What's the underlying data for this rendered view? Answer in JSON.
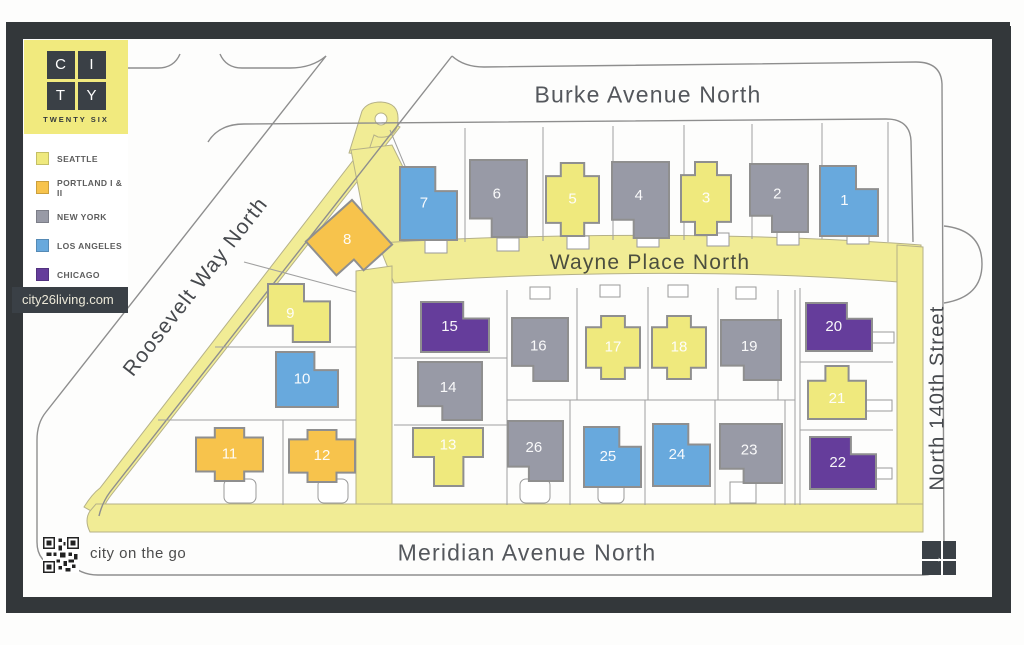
{
  "brand": {
    "logo_letters": [
      "C",
      "I",
      "T",
      "Y"
    ],
    "logo_subtitle": "TWENTY SIX",
    "website": "city26living.com",
    "tagline": "city on the go"
  },
  "legend": {
    "items": [
      {
        "key": "seattle",
        "label": "SEATTLE",
        "color": "#efe97d"
      },
      {
        "key": "portland",
        "label": "PORTLAND I & II",
        "color": "#f7c34c"
      },
      {
        "key": "newyork",
        "label": "NEW YORK",
        "color": "#989aa6"
      },
      {
        "key": "losangeles",
        "label": "LOS ANGELES",
        "color": "#68a9dd"
      },
      {
        "key": "chicago",
        "label": "CHICAGO",
        "color": "#653d9b"
      }
    ]
  },
  "map": {
    "streets": {
      "burke": "Burke Avenue North",
      "wayne": "Wayne Place North",
      "meridian": "Meridian Avenue North",
      "roosevelt": "Roosevelt Way North",
      "n140": "North 140th Street"
    },
    "colors": {
      "seattle": "#efe97d",
      "portland": "#f7c34c",
      "newyork": "#989aa6",
      "losangeles": "#68a9dd",
      "chicago": "#653d9b",
      "road": "#f1ec95"
    },
    "houses": [
      {
        "num": 1,
        "theme": "losangeles",
        "x": 820,
        "y": 166,
        "w": 58,
        "h": 70,
        "shape": "a"
      },
      {
        "num": 2,
        "theme": "newyork",
        "x": 750,
        "y": 164,
        "w": 58,
        "h": 68,
        "shape": "b"
      },
      {
        "num": 3,
        "theme": "seattle",
        "x": 681,
        "y": 162,
        "w": 50,
        "h": 73,
        "shape": "c"
      },
      {
        "num": 4,
        "theme": "newyork",
        "x": 612,
        "y": 162,
        "w": 57,
        "h": 76,
        "shape": "b"
      },
      {
        "num": 5,
        "theme": "seattle",
        "x": 546,
        "y": 163,
        "w": 53,
        "h": 73,
        "shape": "c"
      },
      {
        "num": 6,
        "theme": "newyork",
        "x": 470,
        "y": 160,
        "w": 57,
        "h": 77,
        "shape": "b"
      },
      {
        "num": 7,
        "theme": "losangeles",
        "x": 400,
        "y": 167,
        "w": 57,
        "h": 73,
        "shape": "a"
      },
      {
        "num": 8,
        "theme": "portland",
        "x": 318,
        "y": 213,
        "w": 62,
        "h": 60,
        "shape": "b",
        "rot": -42
      },
      {
        "num": 9,
        "theme": "seattle",
        "x": 268,
        "y": 284,
        "w": 62,
        "h": 58,
        "shape": "g"
      },
      {
        "num": 10,
        "theme": "losangeles",
        "x": 276,
        "y": 352,
        "w": 62,
        "h": 55,
        "shape": "a"
      },
      {
        "num": 11,
        "theme": "portland",
        "x": 196,
        "y": 428,
        "w": 67,
        "h": 53,
        "shape": "c"
      },
      {
        "num": 12,
        "theme": "portland",
        "x": 289,
        "y": 430,
        "w": 66,
        "h": 52,
        "shape": "c"
      },
      {
        "num": 13,
        "theme": "seattle",
        "x": 413,
        "y": 428,
        "w": 70,
        "h": 58,
        "shape": "e"
      },
      {
        "num": 14,
        "theme": "newyork",
        "x": 418,
        "y": 362,
        "w": 64,
        "h": 58,
        "shape": "b"
      },
      {
        "num": 15,
        "theme": "chicago",
        "x": 421,
        "y": 302,
        "w": 68,
        "h": 50,
        "shape": "a"
      },
      {
        "num": 16,
        "theme": "newyork",
        "x": 512,
        "y": 318,
        "w": 56,
        "h": 63,
        "shape": "b"
      },
      {
        "num": 17,
        "theme": "seattle",
        "x": 586,
        "y": 316,
        "w": 54,
        "h": 63,
        "shape": "c"
      },
      {
        "num": 18,
        "theme": "seattle",
        "x": 652,
        "y": 316,
        "w": 54,
        "h": 63,
        "shape": "c"
      },
      {
        "num": 19,
        "theme": "newyork",
        "x": 721,
        "y": 320,
        "w": 60,
        "h": 60,
        "shape": "b"
      },
      {
        "num": 20,
        "theme": "chicago",
        "x": 806,
        "y": 303,
        "w": 66,
        "h": 48,
        "shape": "a"
      },
      {
        "num": 21,
        "theme": "seattle",
        "x": 808,
        "y": 366,
        "w": 58,
        "h": 53,
        "shape": "f"
      },
      {
        "num": 22,
        "theme": "chicago",
        "x": 810,
        "y": 437,
        "w": 66,
        "h": 52,
        "shape": "a"
      },
      {
        "num": 23,
        "theme": "newyork",
        "x": 720,
        "y": 424,
        "w": 62,
        "h": 59,
        "shape": "b"
      },
      {
        "num": 24,
        "theme": "losangeles",
        "x": 653,
        "y": 424,
        "w": 57,
        "h": 62,
        "shape": "a"
      },
      {
        "num": 25,
        "theme": "losangeles",
        "x": 584,
        "y": 427,
        "w": 57,
        "h": 60,
        "shape": "a"
      },
      {
        "num": 26,
        "theme": "newyork",
        "x": 508,
        "y": 421,
        "w": 55,
        "h": 60,
        "shape": "b"
      }
    ]
  }
}
